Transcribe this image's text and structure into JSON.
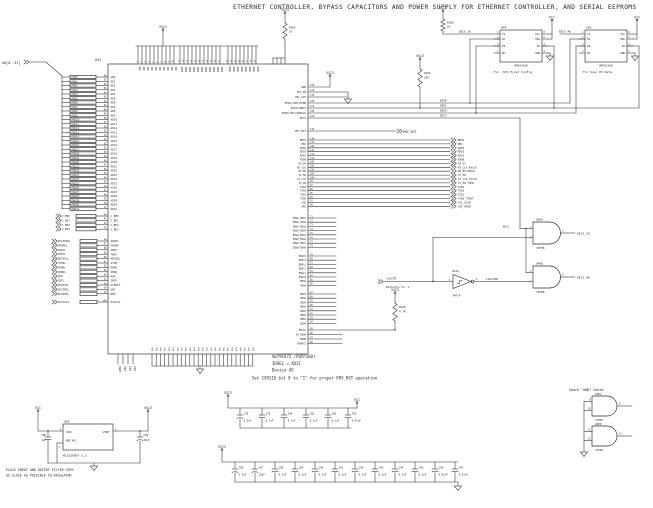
{
  "title": "ETHERNET CONTROLLER, BYPASS CAPACITORS AND POWER SUPPLY FOR ETHERNET CONTROLLER,  AND SERIAL EEPROMS",
  "colors": {
    "ink": "#2a2a2a",
    "bg": "#ffffff"
  },
  "nets": {
    "vcc3": "VCC3",
    "vcc": "VCC"
  },
  "chip": {
    "designator": "U41",
    "part": "Am79C972 (PQFP160)",
    "idsel_note": "IDSEL = AD21",
    "device_note": "Device #5",
    "csr_note": "Set CSR116 bit 0 to \"1\" for proper PHY_RST operation",
    "ad_bus_label": "AD[0..31]",
    "ad_ext_prefix": "PAD",
    "ad_int_prefix": "AD",
    "ad_count": 32,
    "ad_num_start": 68,
    "cbe_pins": [
      {
        "ext": "C_BE0",
        "int": "C_BE0",
        "num": "49"
      },
      {
        "ext": "C_BE1",
        "int": "C_BE1",
        "num": "47"
      },
      {
        "ext": "C_BE2",
        "int": "C_BE2",
        "num": "45"
      },
      {
        "ext": "C_BE3",
        "int": "C_BE3",
        "num": "43"
      }
    ],
    "pci_pins": [
      {
        "ext": "PCIIDSEL",
        "int": "IDSEL",
        "num": "44"
      },
      {
        "ext": "FRAMEL",
        "int": "FRAME",
        "num": "57"
      },
      {
        "ext": "IRDYL",
        "int": "IRDY",
        "num": "58"
      },
      {
        "ext": "TRDYL",
        "int": "TRDY",
        "num": "59"
      },
      {
        "ext": "DEVSELL",
        "int": "DEVSEL",
        "num": "60"
      },
      {
        "ext": "STOPL",
        "int": "STOP",
        "num": "61"
      },
      {
        "ext": "PERRL",
        "int": "PERR",
        "num": "62"
      },
      {
        "ext": "SERRL",
        "int": "SERR",
        "num": "63"
      },
      {
        "ext": "PAR",
        "int": "PAR",
        "num": "64"
      },
      {
        "ext": "INTL",
        "int": "INTA",
        "num": "37"
      },
      {
        "ext": "PCIRSTL",
        "int": "PCIRST",
        "num": "36"
      },
      {
        "ext": "PCIGNTL",
        "int": "GNT",
        "num": "34"
      },
      {
        "ext": "PCIREQL",
        "int": "REQ",
        "num": "33"
      }
    ],
    "pciclk_pin": {
      "ext": "PCICLK3",
      "int": "PCICLK",
      "num": "144"
    },
    "top_clusters": [
      {
        "count": 10,
        "label": "VDD",
        "num_start": 1
      },
      {
        "count": 11,
        "label": "VDDB",
        "num_start": 11
      },
      {
        "count": 8,
        "label": "AVDD",
        "num_start": 22
      }
    ],
    "bottom_pin_label": "VSS",
    "bottom_pin_count": 25,
    "led_pins": [
      "LNKST",
      "LED1",
      "LED2",
      "LED3"
    ],
    "misc_pins": [
      {
        "int": "RWU",
        "num": "135"
      },
      {
        "int": "TRC_IN",
        "num": "134"
      },
      {
        "int": "TRC_OUT",
        "num": "133"
      }
    ],
    "eeprom_pins": [
      {
        "int": "EESK/LED1/SFBD",
        "num": "132",
        "net": "EESK"
      },
      {
        "int": "EEDI/LNKST",
        "num": "131",
        "net": "EEDI"
      },
      {
        "int": "EEDO/LED3/SRDCLK",
        "num": "130",
        "net": "EEDO"
      },
      {
        "int": "EECS",
        "num": "129",
        "net": "EECS"
      }
    ],
    "phy_rst": {
      "int": "PHY_RST",
      "num": "119",
      "ext": "PHY_RST"
    },
    "mii_pins": [
      {
        "int": "MDIO",
        "num": "118",
        "ext": "MDIO"
      },
      {
        "int": "MDC",
        "num": "117",
        "ext": "MDC"
      },
      {
        "int": "RXD3",
        "num": "116",
        "ext": "RXD3"
      },
      {
        "int": "RXD2",
        "num": "114",
        "ext": "RXD2"
      },
      {
        "int": "RXD1",
        "num": "113",
        "ext": "RXD1"
      },
      {
        "int": "RXD0",
        "num": "111",
        "ext": "RXD0"
      },
      {
        "int": "RX_DV",
        "num": "108",
        "ext": "RX_DV"
      },
      {
        "int": "RX_CLK",
        "num": "105",
        "ext": "RX_CLK_RXCLK"
      },
      {
        "int": "RX_ER",
        "num": "104",
        "ext": "RX_ER_RXDAT"
      },
      {
        "int": "TX_ER",
        "num": "103",
        "ext": "TX_ER"
      },
      {
        "int": "TX_CLK",
        "num": "100",
        "ext": "TX_CLK_TXCLK"
      },
      {
        "int": "TX_EN",
        "num": "99",
        "ext": "TX_EN_TXEN"
      },
      {
        "int": "TXD3",
        "num": "97",
        "ext": "TXD3"
      },
      {
        "int": "TXD2",
        "num": "96",
        "ext": "TXD2"
      },
      {
        "int": "TXD1",
        "num": "95",
        "ext": "TXD1"
      },
      {
        "int": "TXD0",
        "num": "92",
        "ext": "TXD0_TXDAT"
      },
      {
        "int": "COL",
        "num": "91",
        "ext": "COL_CLSN"
      },
      {
        "int": "CRS",
        "num": "90",
        "ext": "CRS_RXEN"
      }
    ],
    "ebua_pins": {
      "prefix": "EBUA_EBA",
      "from": 7,
      "to": 0,
      "num_start": 71
    },
    "eba_pins": {
      "prefix": "EBA",
      "from": 15,
      "to": 8,
      "num_start": 79
    },
    "ebd_pins": {
      "prefix": "EBD",
      "from": 7,
      "to": 0,
      "num_start": 87
    },
    "eb_ctrl_pins": [
      {
        "int": "EBCLK",
        "num": "95"
      },
      {
        "int": "AS_EBOE",
        "num": "96"
      },
      {
        "int": "EBWE",
        "num": "97"
      },
      {
        "int": "EROMCS",
        "num": "98"
      }
    ]
  },
  "resistors": {
    "r455": {
      "des": "R455",
      "val": "1K"
    },
    "r108": {
      "des": "R108",
      "val": "1K"
    },
    "r104": {
      "des": "R104",
      "val": "10K"
    },
    "r106": {
      "des": "R106",
      "val": "4.7K"
    }
  },
  "eeproms": {
    "u44": {
      "des": "U44",
      "part": "NM93C46N",
      "caption": "For '972 E/net Config.",
      "cs_net": "EECS_1K",
      "vcc_net": "VCC",
      "left_pins": [
        {
          "num": "1",
          "label": "CS"
        },
        {
          "num": "2",
          "label": "SK"
        },
        {
          "num": "3",
          "label": "DI"
        },
        {
          "num": "7",
          "label": "NC"
        }
      ],
      "right_pins": [
        {
          "num": "8",
          "label": "VCC"
        },
        {
          "num": "6",
          "label": "ORG"
        },
        {
          "num": "4",
          "label": "DO"
        },
        {
          "num": "5",
          "label": "GND"
        }
      ]
    },
    "u45": {
      "des": "U45",
      "part": "NM93C66N",
      "caption": "For User EV Data",
      "cs_net": "EECS_4K",
      "vcc_net": "VCC",
      "left_pins": [
        {
          "num": "1",
          "label": "CS"
        },
        {
          "num": "2",
          "label": "SK"
        },
        {
          "num": "3",
          "label": "DI"
        },
        {
          "num": "7",
          "label": "NC"
        }
      ],
      "right_pins": [
        {
          "num": "8",
          "label": "VCC"
        },
        {
          "num": "6",
          "label": "ORG"
        },
        {
          "num": "4",
          "label": "DO"
        },
        {
          "num": "5",
          "label": "GND"
        }
      ]
    }
  },
  "gates": {
    "eecs_net": "EECS",
    "u40a": {
      "des": "U40A",
      "part": "74F08",
      "in1": "1",
      "in2": "2",
      "out": "3",
      "out_net": "EECS_1K"
    },
    "u40b": {
      "des": "U40B",
      "part": "74F08",
      "in1": "4",
      "in2": "5",
      "out": "6",
      "out_net": "EECS_4K"
    },
    "u43a": {
      "des": "U43A",
      "part": "74F14",
      "in": "1",
      "out": "2",
      "in_net": "C1ACTR",
      "in_note": "Defaults to '1'",
      "out_net": "C1ACTRB"
    },
    "spare": {
      "title": "Spare \"AND\" Gates",
      "list": [
        {
          "des": "U40C",
          "part": "74F08",
          "in1": "9",
          "in2": "10",
          "out": "8"
        },
        {
          "des": "U40D",
          "part": "74F08",
          "in1": "12",
          "in2": "13",
          "out": "11"
        }
      ]
    }
  },
  "regulator": {
    "des": "U50",
    "part": "MC33269DT-3.3",
    "vin": {
      "num": "3",
      "label": "VIN"
    },
    "gnd": {
      "num": "1",
      "label": "GND_ADJ"
    },
    "vout": {
      "num": "2",
      "label": "VOUT"
    },
    "in_net": "VCC",
    "out_net": "VCC3",
    "cin": {
      "des": "C86",
      "val": "1uF"
    },
    "cout": {
      "des": "C84",
      "val": "10uF"
    },
    "note1": "PLACE INPUT AND OUTPUT FILTER CAPS",
    "note2": "AS CLOSE AS POSSIBLE TO REGULATOR"
  },
  "bypass": {
    "row1": {
      "net_left": "VCC3",
      "net_right": "VCC",
      "caps": [
        {
          "des": "C78",
          "val": "2.2uF",
          "polar": true
        },
        {
          "des": "C79",
          "val": "0.1uF"
        },
        {
          "des": "C80",
          "val": "0.1uF"
        },
        {
          "des": "C81",
          "val": "0.1uF"
        },
        {
          "des": "C82",
          "val": "0.1uF"
        },
        {
          "des": "C83",
          "val": "0.01uF"
        }
      ]
    },
    "row2": {
      "net_left": "VCC3",
      "caps": [
        {
          "des": "C85",
          "val": "2.2uF",
          "polar": true
        },
        {
          "des": "C87",
          "val": "10uF",
          "polar": true
        },
        {
          "des": "C88",
          "val": "0.1uF"
        },
        {
          "des": "C89",
          "val": "0.1uF"
        },
        {
          "des": "C90",
          "val": "0.1uF"
        },
        {
          "des": "C91",
          "val": "0.1uF"
        },
        {
          "des": "C92",
          "val": "0.1uF"
        },
        {
          "des": "C93",
          "val": "0.1uF"
        },
        {
          "des": "C94",
          "val": "0.1uF"
        },
        {
          "des": "C95",
          "val": "0.1uF"
        },
        {
          "des": "C96",
          "val": "0.01uF"
        },
        {
          "des": "C97",
          "val": "0.01uF"
        }
      ]
    }
  }
}
